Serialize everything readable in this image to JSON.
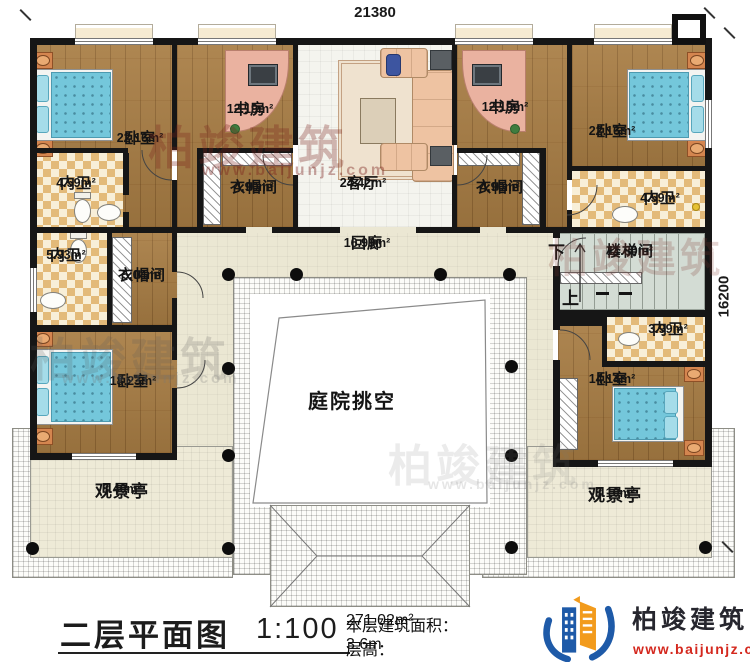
{
  "dimensions": {
    "top": "21380",
    "right": "16200"
  },
  "rooms": {
    "bedroom_tl": {
      "name": "卧室",
      "area": "22.16m²"
    },
    "study_l": {
      "name": "书房",
      "area": "12.19m²"
    },
    "living": {
      "name": "客厅",
      "area": "24.42m²"
    },
    "study_r": {
      "name": "书房",
      "area": "12.19m²"
    },
    "bedroom_tr": {
      "name": "卧室",
      "area": "22.16m²"
    },
    "bath_l1": {
      "name": "内卫",
      "area": "4.59m²"
    },
    "closet_l1": {
      "name": "衣帽间",
      "area": "4.90m²"
    },
    "closet_r1": {
      "name": "衣帽间",
      "area": "4.90m²"
    },
    "bath_r1": {
      "name": "内卫",
      "area": "4.59m²"
    },
    "bath_l2": {
      "name": "内卫",
      "area": "5.93m²"
    },
    "closet_l2": {
      "name": "衣帽间",
      "area": "5.04m²"
    },
    "corridor": {
      "name": "回廊",
      "area": "16.99m²"
    },
    "stairwell": {
      "name": "楼梯间",
      "area": "11.80m²",
      "down": "下",
      "up": "上"
    },
    "bedroom_bl": {
      "name": "卧室",
      "area": "18.23m²"
    },
    "bath_r2": {
      "name": "内卫",
      "area": "3.99m²"
    },
    "bedroom_br": {
      "name": "卧室",
      "area": "14.14m²"
    },
    "courtyard": {
      "name": "庭院挑空"
    },
    "pavilion_l": {
      "name": "观景亭",
      "area": "8.40m²"
    },
    "pavilion_r": {
      "name": "观景亭",
      "area": "8.10m²"
    }
  },
  "title_block": {
    "title": "二层平面图",
    "scale": "1:100",
    "floor_area_label": "本层建筑面积：",
    "floor_area_value": "271.02m²",
    "story_height_label": "层高：",
    "story_height_value": "3.6m"
  },
  "brand": {
    "name": "柏竣建筑",
    "website": "www.baijunjz.com"
  },
  "watermark": {
    "name": "柏竣建筑",
    "website": "www.baijunjz.com"
  },
  "colors": {
    "wall": "#161616",
    "wood": "#a87d44",
    "tile": "#e3ba79",
    "bed": "#74c7db",
    "brand_blue": "#1e5aa8",
    "brand_orange": "#f29b1d",
    "brand_red": "#d4281e"
  }
}
